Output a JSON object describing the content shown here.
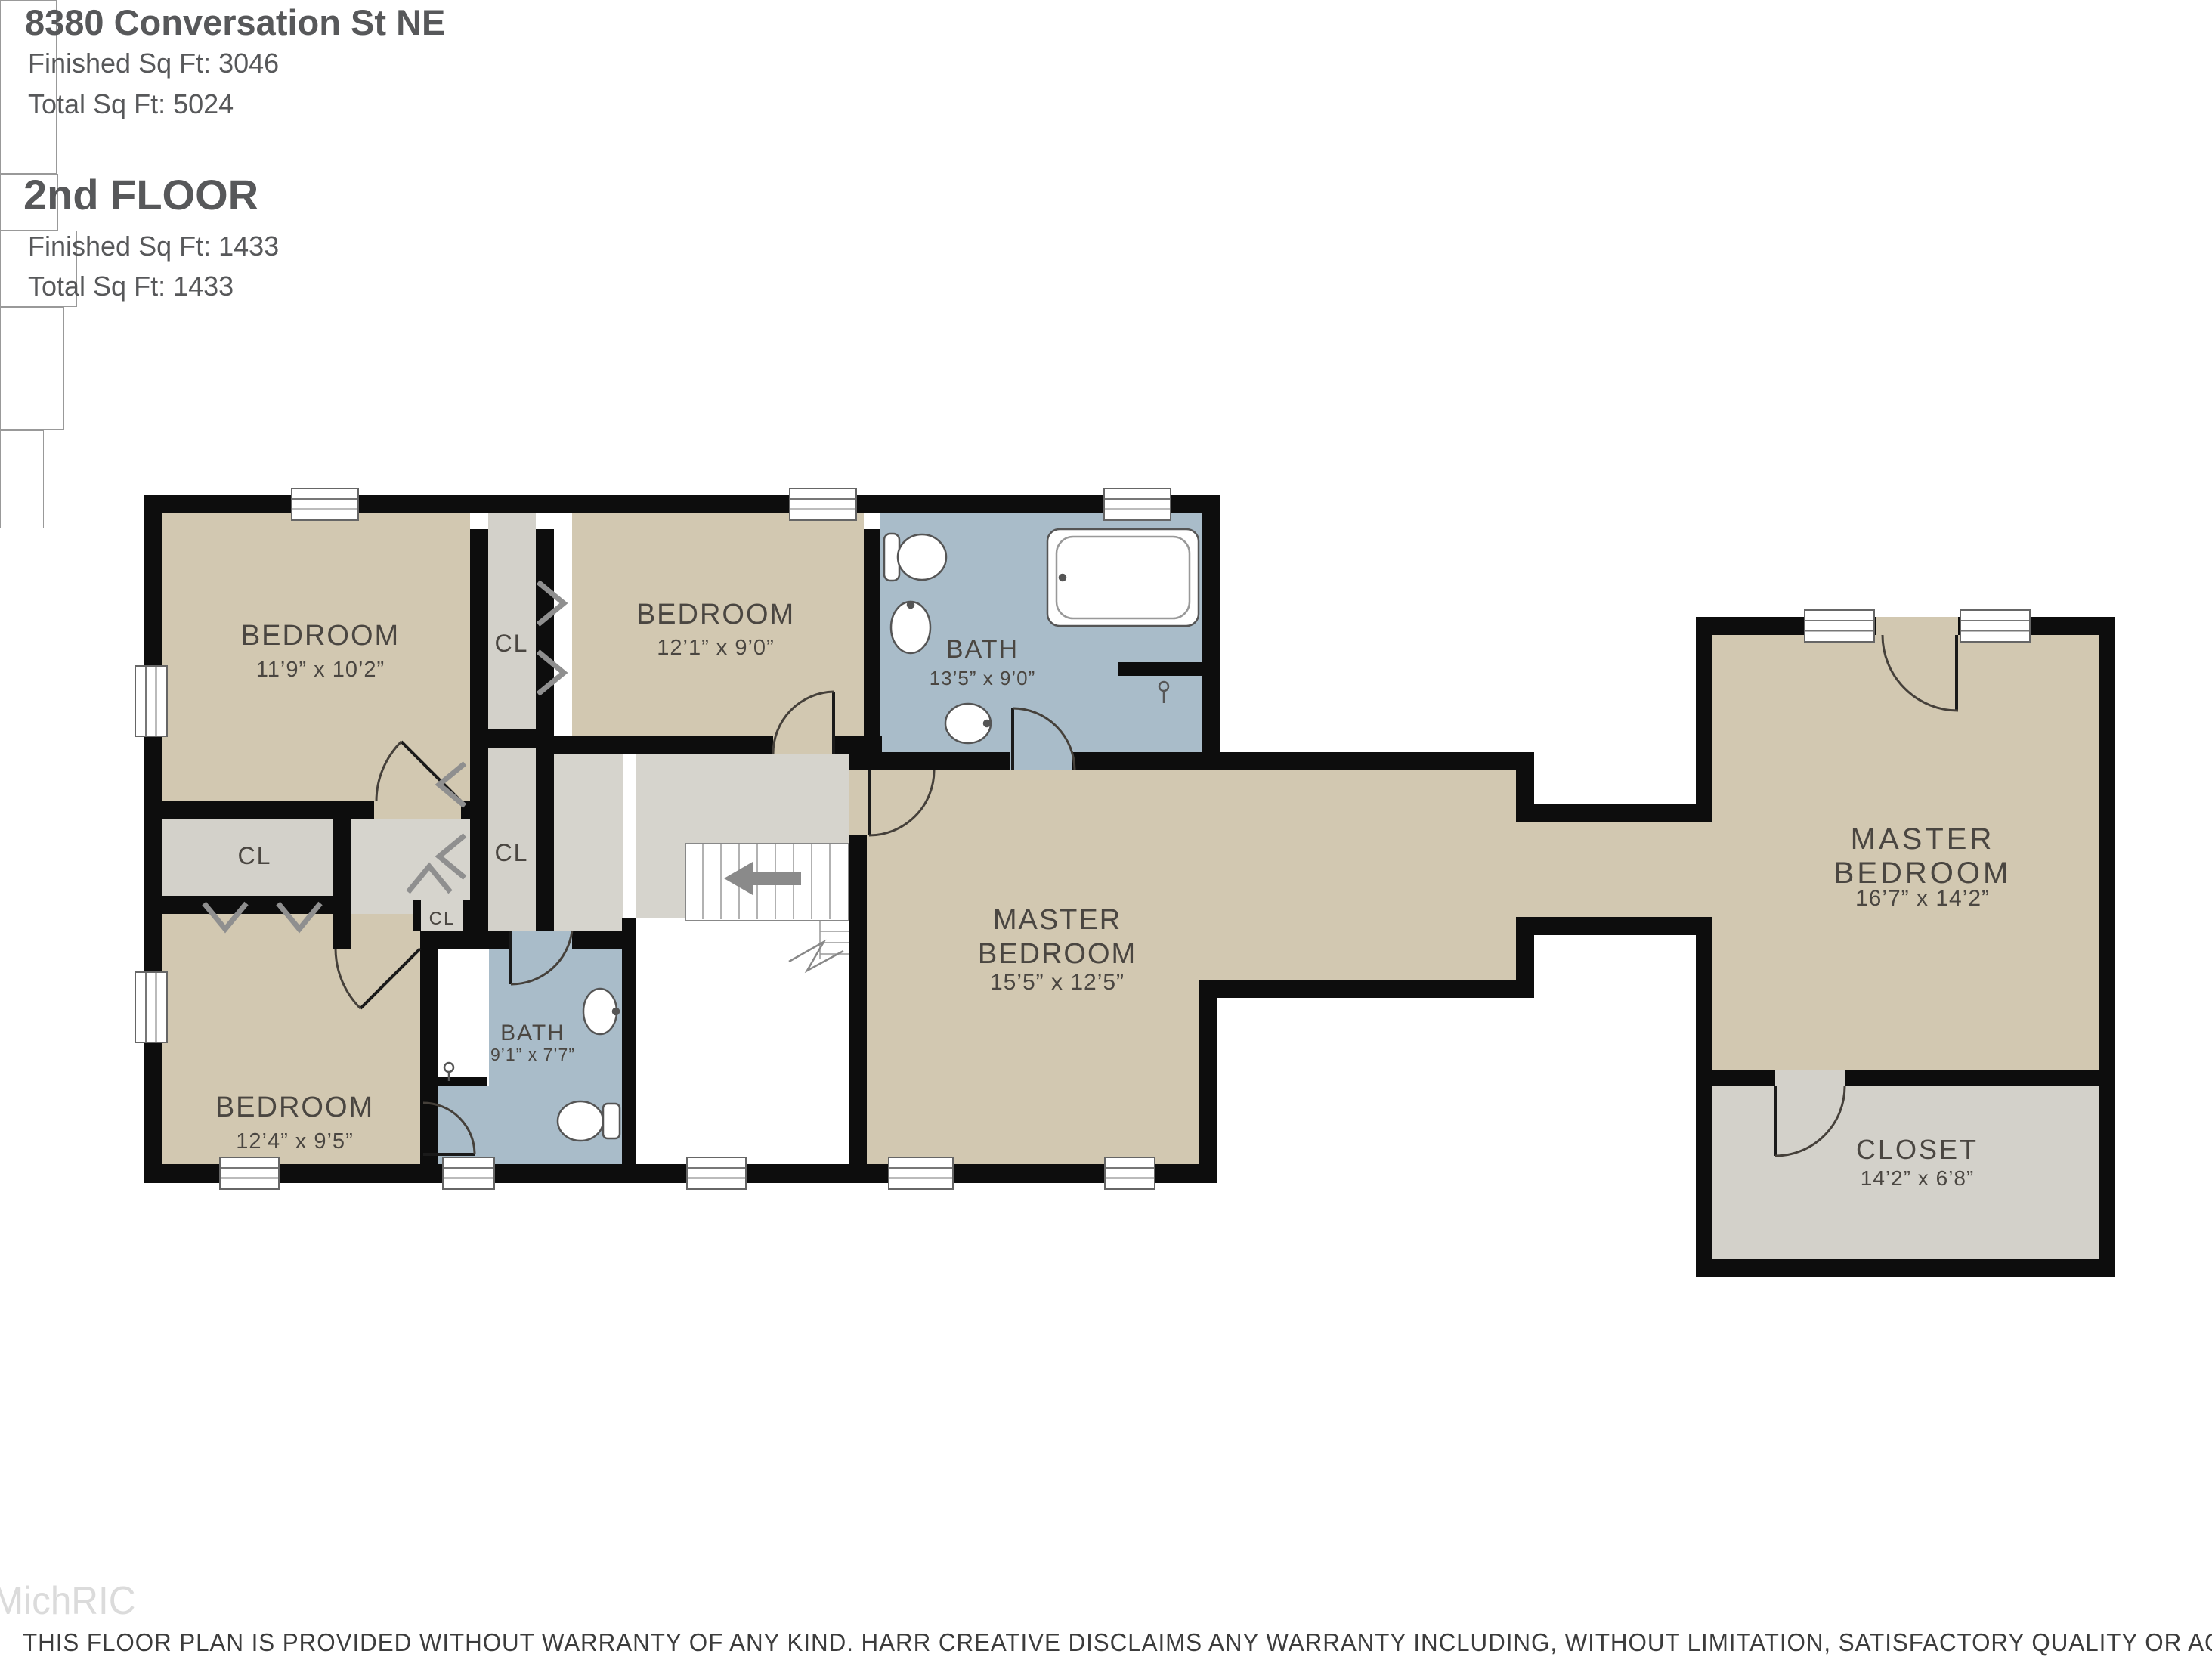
{
  "header": {
    "address": "8380 Conversation St NE",
    "finished_sqft": "Finished Sq Ft: 3046",
    "total_sqft": "Total Sq Ft: 5024",
    "floor_title": "2nd FLOOR",
    "floor_finished_sqft": "Finished Sq Ft: 1433",
    "floor_total_sqft": "Total Sq Ft: 1433"
  },
  "rooms": {
    "bedroom1": {
      "name": "BEDROOM",
      "dims": "11’9” x 10’2”"
    },
    "bedroom2": {
      "name": "BEDROOM",
      "dims": "12’1” x 9’0”"
    },
    "bath1": {
      "name": "BATH",
      "dims": "13’5” x 9’0”"
    },
    "bedroom3": {
      "name": "BEDROOM",
      "dims": "12’4” x 9’5”"
    },
    "bath2": {
      "name": "BATH",
      "dims": "9’1” x 7’7”"
    },
    "master_center": {
      "line1": "MASTER",
      "line2": "BEDROOM",
      "dims": "15’5” x 12’5”"
    },
    "master_right": {
      "line1": "MASTER",
      "line2": "BEDROOM",
      "dims": "16’7” x 14’2”"
    },
    "closet_right": {
      "name": "CLOSET",
      "dims": "14’2” x 6’8”"
    }
  },
  "closet_labels": {
    "between_bedrooms_top": "CL",
    "between_bedrooms_bottom": "CL",
    "hall": "CL",
    "small": "CL"
  },
  "watermark": "MichRIC",
  "disclaimer": "THIS FLOOR PLAN IS PROVIDED WITHOUT WARRANTY OF ANY KIND. HARR CREATIVE DISCLAIMS ANY WARRANTY INCLUDING, WITHOUT LIMITATION, SATISFACTORY QUALITY OR ACCURACY OF DIMENSIONS",
  "colors": {
    "wall": "#0d0d0d",
    "room_tan": "#d2c8b1",
    "room_gray": "#d3d1ca",
    "room_blue": "#a9bcc9",
    "hall_gray": "#d6d4cd",
    "label_text": "#4a4641",
    "header_text": "#57585a"
  }
}
